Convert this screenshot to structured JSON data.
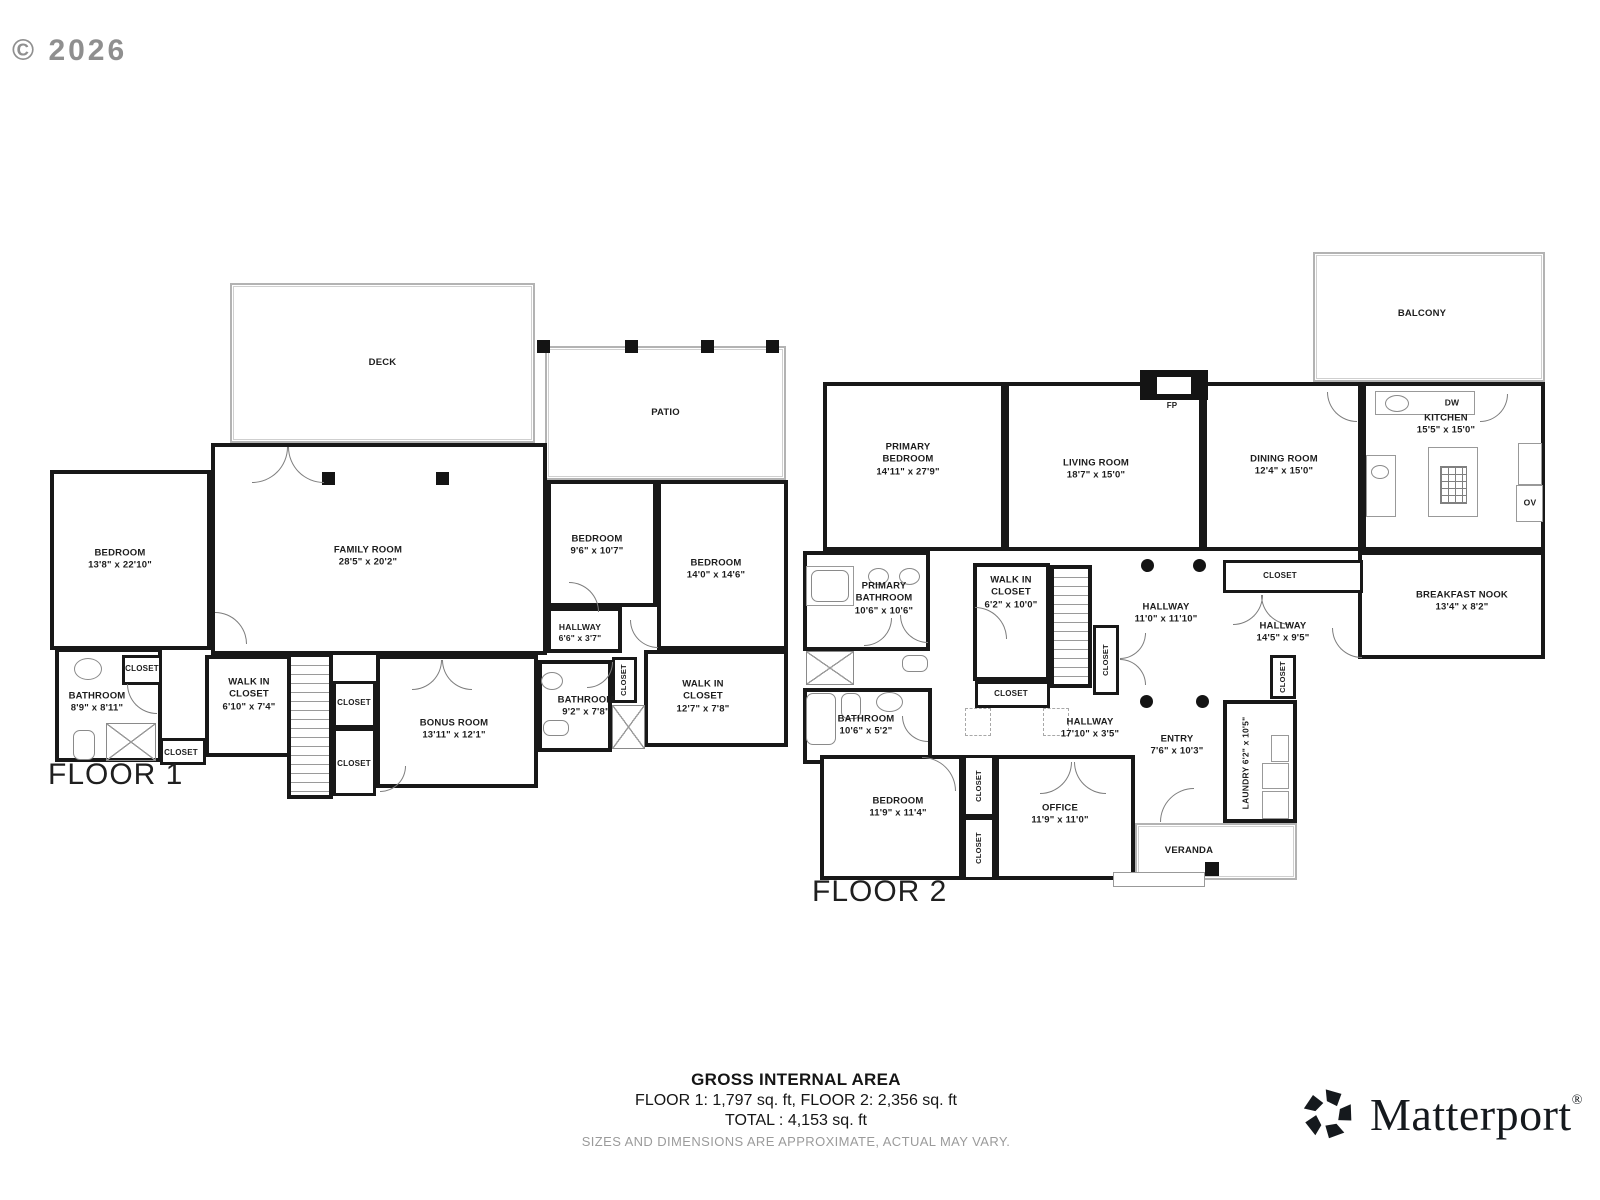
{
  "copyright": "© 2026",
  "summary": {
    "title": "GROSS INTERNAL AREA",
    "line1": "FLOOR 1:  1,797 sq. ft, FLOOR 2:  2,356 sq. ft",
    "line2": "TOTAL :  4,153 sq. ft",
    "disclaimer": "SIZES AND DIMENSIONS ARE APPROXIMATE, ACTUAL MAY VARY."
  },
  "brand": {
    "name": "Matterport",
    "registered": "®"
  },
  "floors": [
    {
      "id": "floor-1",
      "label": "FLOOR 1",
      "label_x": 48,
      "label_y": 758,
      "rooms": [
        {
          "id": "deck",
          "label": "DECK",
          "type": "outdoor",
          "x": 230,
          "y": 283,
          "w": 305,
          "h": 160
        },
        {
          "id": "patio",
          "label": "PATIO",
          "type": "outdoor",
          "x": 545,
          "y": 346,
          "w": 241,
          "h": 134
        },
        {
          "id": "bedroom-1",
          "label": "BEDROOM",
          "dims": "13'8\" x 22'10\"",
          "x": 50,
          "y": 470,
          "w": 161,
          "h": 180,
          "lx": 120,
          "ly": 560
        },
        {
          "id": "family-room",
          "label": "FAMILY ROOM",
          "dims": "28'5\" x 20'2\"",
          "x": 211,
          "y": 443,
          "w": 336,
          "h": 212,
          "lx": 368,
          "ly": 557
        },
        {
          "id": "bedroom-2",
          "label": "BEDROOM",
          "dims": "9'6\" x 10'7\"",
          "x": 547,
          "y": 480,
          "w": 110,
          "h": 127,
          "lx": 597,
          "ly": 546
        },
        {
          "id": "bedroom-3",
          "label": "BEDROOM",
          "dims": "14'0\" x 14'6\"",
          "x": 657,
          "y": 480,
          "w": 131,
          "h": 170,
          "lx": 716,
          "ly": 570
        },
        {
          "id": "hallway-f1",
          "label": "HALLWAY",
          "dims": "6'6\" x 3'7\"",
          "x": 547,
          "y": 607,
          "w": 75,
          "h": 46,
          "fs": 8.5,
          "lx": 580,
          "ly": 633
        },
        {
          "id": "bathroom-1",
          "label": "BATHROOM",
          "dims": "8'9\" x 8'11\"",
          "x": 55,
          "y": 648,
          "w": 107,
          "h": 114,
          "lx": 97,
          "ly": 703
        },
        {
          "id": "closet-f1-a",
          "label": "CLOSET",
          "sm": true,
          "x": 122,
          "y": 655,
          "w": 40,
          "h": 30,
          "fs": 8,
          "lx": 142,
          "ly": 669
        },
        {
          "id": "closet-f1-b",
          "label": "CLOSET",
          "sm": true,
          "x": 160,
          "y": 738,
          "w": 46,
          "h": 27,
          "fs": 8,
          "lx": 181,
          "ly": 753
        },
        {
          "id": "walkin-closet-f1-a",
          "label": "WALK IN\nCLOSET",
          "dims": "6'10\" x 7'4\"",
          "x": 205,
          "y": 655,
          "w": 102,
          "h": 102,
          "lx": 249,
          "ly": 695
        },
        {
          "id": "stairs-f1",
          "type": "stairs",
          "x": 287,
          "y": 653,
          "w": 46,
          "h": 146
        },
        {
          "id": "closet-f1-c",
          "label": "CLOSET",
          "sm": true,
          "x": 333,
          "y": 681,
          "w": 43,
          "h": 47,
          "fs": 8,
          "lx": 354,
          "ly": 703
        },
        {
          "id": "closet-f1-d",
          "label": "CLOSET",
          "sm": true,
          "x": 333,
          "y": 728,
          "w": 43,
          "h": 68,
          "fs": 8,
          "lx": 354,
          "ly": 764
        },
        {
          "id": "bonus-room",
          "label": "BONUS ROOM",
          "dims": "13'11\" x 12'1\"",
          "x": 376,
          "y": 655,
          "w": 162,
          "h": 133,
          "lx": 454,
          "ly": 730
        },
        {
          "id": "bathroom-2",
          "label": "BATHROOM",
          "dims": "9'2\" x 7'8\"",
          "x": 538,
          "y": 660,
          "w": 74,
          "h": 92,
          "lx": 586,
          "ly": 707
        },
        {
          "id": "closet-f1-e",
          "label": "CLOSET",
          "sm": true,
          "vertical": true,
          "x": 612,
          "y": 657,
          "w": 25,
          "h": 46,
          "fs": 7.5,
          "lx": 624,
          "ly": 680
        },
        {
          "id": "walkin-closet-f1-b",
          "label": "WALK IN\nCLOSET",
          "dims": "12'7\" x 7'8\"",
          "x": 644,
          "y": 650,
          "w": 144,
          "h": 97,
          "lx": 703,
          "ly": 697
        }
      ],
      "decor": [
        {
          "k": "post",
          "x": 537,
          "y": 340,
          "w": 13,
          "h": 13
        },
        {
          "k": "post",
          "x": 625,
          "y": 340,
          "w": 13,
          "h": 13
        },
        {
          "k": "post",
          "x": 701,
          "y": 340,
          "w": 13,
          "h": 13
        },
        {
          "k": "post",
          "x": 766,
          "y": 340,
          "w": 13,
          "h": 13
        },
        {
          "k": "post",
          "x": 322,
          "y": 472,
          "w": 13,
          "h": 13
        },
        {
          "k": "post",
          "x": 436,
          "y": 472,
          "w": 13,
          "h": 13
        },
        {
          "k": "shower",
          "x": 106,
          "y": 723,
          "w": 50,
          "h": 38
        },
        {
          "k": "oval",
          "x": 74,
          "y": 658,
          "w": 28,
          "h": 22
        },
        {
          "k": "tub",
          "x": 73,
          "y": 730,
          "w": 22,
          "h": 30
        },
        {
          "k": "oval",
          "x": 541,
          "y": 672,
          "w": 22,
          "h": 18
        },
        {
          "k": "tub",
          "x": 543,
          "y": 720,
          "w": 26,
          "h": 16
        },
        {
          "k": "shower",
          "x": 612,
          "y": 705,
          "w": 33,
          "h": 44
        }
      ],
      "doors": [
        {
          "x": 252,
          "y": 447,
          "s": 36,
          "h": "tl"
        },
        {
          "x": 288,
          "y": 447,
          "s": 36,
          "h": "tr"
        },
        {
          "x": 215,
          "y": 612,
          "s": 32,
          "h": "bl"
        },
        {
          "x": 412,
          "y": 660,
          "s": 30,
          "h": "tl"
        },
        {
          "x": 442,
          "y": 660,
          "s": 30,
          "h": "tr"
        },
        {
          "x": 127,
          "y": 684,
          "s": 30,
          "h": "tr"
        },
        {
          "x": 380,
          "y": 766,
          "s": 26,
          "h": "tl"
        },
        {
          "x": 587,
          "y": 662,
          "s": 26,
          "h": "tl"
        },
        {
          "x": 630,
          "y": 620,
          "s": 28,
          "h": "tr"
        },
        {
          "x": 569,
          "y": 582,
          "s": 30,
          "h": "bl"
        }
      ]
    },
    {
      "id": "floor-2",
      "label": "FLOOR 2",
      "label_x": 812,
      "label_y": 875,
      "rooms": [
        {
          "id": "balcony",
          "label": "BALCONY",
          "type": "outdoor",
          "x": 1313,
          "y": 252,
          "w": 232,
          "h": 130,
          "lx": 1422,
          "ly": 314
        },
        {
          "id": "primary-bedroom",
          "label": "PRIMARY\nBEDROOM",
          "dims": "14'11\" x 27'9\"",
          "x": 823,
          "y": 382,
          "w": 182,
          "h": 169,
          "lx": 908,
          "ly": 460
        },
        {
          "id": "living-room",
          "label": "LIVING ROOM",
          "dims": "18'7\" x 15'0\"",
          "x": 1005,
          "y": 382,
          "w": 198,
          "h": 169,
          "lx": 1096,
          "ly": 470
        },
        {
          "id": "dining-room",
          "label": "DINING ROOM",
          "dims": "12'4\" x 15'0\"",
          "x": 1203,
          "y": 382,
          "w": 159,
          "h": 169,
          "lx": 1284,
          "ly": 466
        },
        {
          "id": "kitchen",
          "label": "KITCHEN",
          "dims": "15'5\" x 15'0\"",
          "x": 1362,
          "y": 382,
          "w": 183,
          "h": 169,
          "lx": 1446,
          "ly": 425
        },
        {
          "id": "breakfast-nook",
          "label": "BREAKFAST NOOK",
          "dims": "13'4\" x 8'2\"",
          "x": 1358,
          "y": 551,
          "w": 187,
          "h": 108,
          "lx": 1462,
          "ly": 602
        },
        {
          "id": "primary-bathroom",
          "label": "PRIMARY\nBATHROOM",
          "dims": "10'6\" x 10'6\"",
          "x": 803,
          "y": 551,
          "w": 127,
          "h": 100,
          "lx": 884,
          "ly": 599
        },
        {
          "id": "walkin-closet-f2",
          "label": "WALK IN\nCLOSET",
          "dims": "6'2\" x 10'0\"",
          "x": 973,
          "y": 563,
          "w": 77,
          "h": 118,
          "lx": 1011,
          "ly": 593
        },
        {
          "id": "closet-f2-f",
          "label": "CLOSET",
          "sm": true,
          "x": 975,
          "y": 681,
          "w": 75,
          "h": 27,
          "fs": 8,
          "lx": 1011,
          "ly": 694
        },
        {
          "id": "stairs-f2",
          "type": "stairs",
          "x": 1050,
          "y": 565,
          "w": 42,
          "h": 123
        },
        {
          "id": "hallway-f2-a",
          "label": "HALLWAY",
          "dims": "11'0\" x 11'10\"",
          "type": "open",
          "x": 1106,
          "y": 585,
          "w": 120,
          "h": 60,
          "lx": 1166,
          "ly": 614
        },
        {
          "id": "closet-f2-g",
          "label": "CLOSET",
          "sm": true,
          "vertical": true,
          "x": 1093,
          "y": 625,
          "w": 26,
          "h": 70,
          "fs": 7.5,
          "lx": 1106,
          "ly": 660
        },
        {
          "id": "closet-f2-h",
          "label": "CLOSET",
          "sm": true,
          "x": 1223,
          "y": 560,
          "w": 140,
          "h": 33,
          "fs": 8,
          "lx": 1280,
          "ly": 576
        },
        {
          "id": "hallway-f2-b",
          "label": "HALLWAY",
          "dims": "14'5\" x 9'5\"",
          "type": "open",
          "x": 1213,
          "y": 605,
          "w": 140,
          "h": 58,
          "lx": 1283,
          "ly": 633
        },
        {
          "id": "closet-f2-i",
          "label": "CLOSET",
          "sm": true,
          "vertical": true,
          "x": 1270,
          "y": 655,
          "w": 26,
          "h": 44,
          "fs": 7.5,
          "lx": 1283,
          "ly": 677
        },
        {
          "id": "bathroom-3",
          "label": "BATHROOM",
          "dims": "10'6\" x 5'2\"",
          "x": 803,
          "y": 688,
          "w": 129,
          "h": 76,
          "lx": 866,
          "ly": 726
        },
        {
          "id": "hallway-f2-c",
          "label": "HALLWAY",
          "dims": "17'10\" x 3'5\"",
          "type": "open",
          "x": 1010,
          "y": 706,
          "w": 160,
          "h": 46,
          "lx": 1090,
          "ly": 729
        },
        {
          "id": "entry",
          "label": "ENTRY",
          "dims": "7'6\" x 10'3\"",
          "type": "open",
          "x": 1130,
          "y": 700,
          "w": 95,
          "h": 92,
          "lx": 1177,
          "ly": 746
        },
        {
          "id": "laundry",
          "label": "LAUNDRY",
          "dims": "6'2\" x 10'5\"",
          "vertical": true,
          "x": 1223,
          "y": 700,
          "w": 74,
          "h": 123,
          "fs": 8.5,
          "lx": 1246,
          "ly": 763
        },
        {
          "id": "bedroom-4",
          "label": "BEDROOM",
          "dims": "11'9\" x 11'4\"",
          "x": 820,
          "y": 755,
          "w": 143,
          "h": 125,
          "lx": 898,
          "ly": 808
        },
        {
          "id": "closet-f2-j",
          "label": "CLOSET",
          "sm": true,
          "vertical": true,
          "x": 963,
          "y": 755,
          "w": 32,
          "h": 62,
          "fs": 7.5,
          "lx": 979,
          "ly": 786
        },
        {
          "id": "closet-f2-k",
          "label": "CLOSET",
          "sm": true,
          "vertical": true,
          "x": 963,
          "y": 817,
          "w": 32,
          "h": 63,
          "fs": 7.5,
          "lx": 979,
          "ly": 848
        },
        {
          "id": "office",
          "label": "OFFICE",
          "dims": "11'9\" x 11'0\"",
          "x": 995,
          "y": 755,
          "w": 140,
          "h": 125,
          "lx": 1060,
          "ly": 815
        },
        {
          "id": "veranda",
          "label": "VERANDA",
          "type": "outdoor",
          "x": 1135,
          "y": 823,
          "w": 162,
          "h": 57,
          "lx": 1189,
          "ly": 851
        },
        {
          "id": "fp-label",
          "label": "FP",
          "type": "open",
          "x": 1156,
          "y": 399,
          "w": 32,
          "h": 14,
          "fs": 8,
          "lx": 1172,
          "ly": 406
        },
        {
          "id": "dw-label",
          "label": "DW",
          "type": "open",
          "x": 1437,
          "y": 396,
          "w": 30,
          "h": 14,
          "fs": 8.5,
          "lx": 1452,
          "ly": 403
        },
        {
          "id": "ov-label",
          "label": "OV",
          "type": "open",
          "x": 1517,
          "y": 486,
          "w": 26,
          "h": 34,
          "fs": 8.5,
          "lx": 1530,
          "ly": 503
        }
      ],
      "decor": [
        {
          "k": "post",
          "x": 1140,
          "y": 370,
          "w": 68,
          "h": 30
        },
        {
          "k": "white",
          "x": 1157,
          "y": 377,
          "w": 34,
          "h": 17
        },
        {
          "k": "col",
          "x": 1141,
          "y": 559,
          "w": 13,
          "h": 13
        },
        {
          "k": "col",
          "x": 1193,
          "y": 559,
          "w": 13,
          "h": 13
        },
        {
          "k": "col",
          "x": 1140,
          "y": 695,
          "w": 13,
          "h": 13
        },
        {
          "k": "col",
          "x": 1196,
          "y": 695,
          "w": 13,
          "h": 13
        },
        {
          "k": "box",
          "x": 1375,
          "y": 391,
          "w": 100,
          "h": 24
        },
        {
          "k": "oval",
          "x": 1385,
          "y": 395,
          "w": 24,
          "h": 17
        },
        {
          "k": "box",
          "x": 1428,
          "y": 447,
          "w": 50,
          "h": 70
        },
        {
          "k": "grid",
          "x": 1440,
          "y": 466,
          "w": 27,
          "h": 38
        },
        {
          "k": "box",
          "x": 1366,
          "y": 455,
          "w": 30,
          "h": 62
        },
        {
          "k": "oval",
          "x": 1371,
          "y": 465,
          "w": 18,
          "h": 14
        },
        {
          "k": "box",
          "x": 1518,
          "y": 443,
          "w": 24,
          "h": 42
        },
        {
          "k": "box",
          "x": 1516,
          "y": 485,
          "w": 27,
          "h": 37
        },
        {
          "k": "box",
          "x": 806,
          "y": 566,
          "w": 48,
          "h": 40
        },
        {
          "k": "tub",
          "x": 811,
          "y": 570,
          "w": 38,
          "h": 32
        },
        {
          "k": "oval",
          "x": 868,
          "y": 568,
          "w": 21,
          "h": 17
        },
        {
          "k": "oval",
          "x": 899,
          "y": 568,
          "w": 21,
          "h": 17
        },
        {
          "k": "shower",
          "x": 806,
          "y": 651,
          "w": 48,
          "h": 34
        },
        {
          "k": "tub",
          "x": 902,
          "y": 655,
          "w": 26,
          "h": 17
        },
        {
          "k": "tub",
          "x": 806,
          "y": 693,
          "w": 30,
          "h": 52
        },
        {
          "k": "tub",
          "x": 841,
          "y": 693,
          "w": 20,
          "h": 26
        },
        {
          "k": "oval",
          "x": 876,
          "y": 692,
          "w": 27,
          "h": 20
        },
        {
          "k": "box",
          "x": 1271,
          "y": 735,
          "w": 18,
          "h": 27
        },
        {
          "k": "box",
          "x": 1262,
          "y": 763,
          "w": 27,
          "h": 26
        },
        {
          "k": "box",
          "x": 1262,
          "y": 791,
          "w": 27,
          "h": 28
        },
        {
          "k": "dash",
          "x": 965,
          "y": 708,
          "w": 26,
          "h": 28
        },
        {
          "k": "dash",
          "x": 1043,
          "y": 708,
          "w": 26,
          "h": 28
        },
        {
          "k": "post",
          "x": 1205,
          "y": 862,
          "w": 14,
          "h": 14
        },
        {
          "k": "box",
          "x": 1113,
          "y": 872,
          "w": 92,
          "h": 15
        }
      ],
      "doors": [
        {
          "x": 864,
          "y": 618,
          "s": 28,
          "h": "tl"
        },
        {
          "x": 900,
          "y": 615,
          "s": 28,
          "h": "tr"
        },
        {
          "x": 975,
          "y": 607,
          "s": 32,
          "h": "bl"
        },
        {
          "x": 1120,
          "y": 633,
          "s": 26,
          "h": "tl"
        },
        {
          "x": 1120,
          "y": 659,
          "s": 26,
          "h": "bl"
        },
        {
          "x": 1233,
          "y": 595,
          "s": 30,
          "h": "tl"
        },
        {
          "x": 1261,
          "y": 595,
          "s": 30,
          "h": "tr"
        },
        {
          "x": 1332,
          "y": 628,
          "s": 30,
          "h": "tr"
        },
        {
          "x": 1160,
          "y": 788,
          "s": 34,
          "h": "br"
        },
        {
          "x": 922,
          "y": 757,
          "s": 34,
          "h": "bl"
        },
        {
          "x": 1040,
          "y": 762,
          "s": 32,
          "h": "tl"
        },
        {
          "x": 1074,
          "y": 762,
          "s": 32,
          "h": "tr"
        },
        {
          "x": 1327,
          "y": 392,
          "s": 30,
          "h": "tr"
        },
        {
          "x": 1480,
          "y": 394,
          "s": 28,
          "h": "tl"
        },
        {
          "x": 902,
          "y": 716,
          "s": 26,
          "h": "tr"
        }
      ]
    }
  ]
}
